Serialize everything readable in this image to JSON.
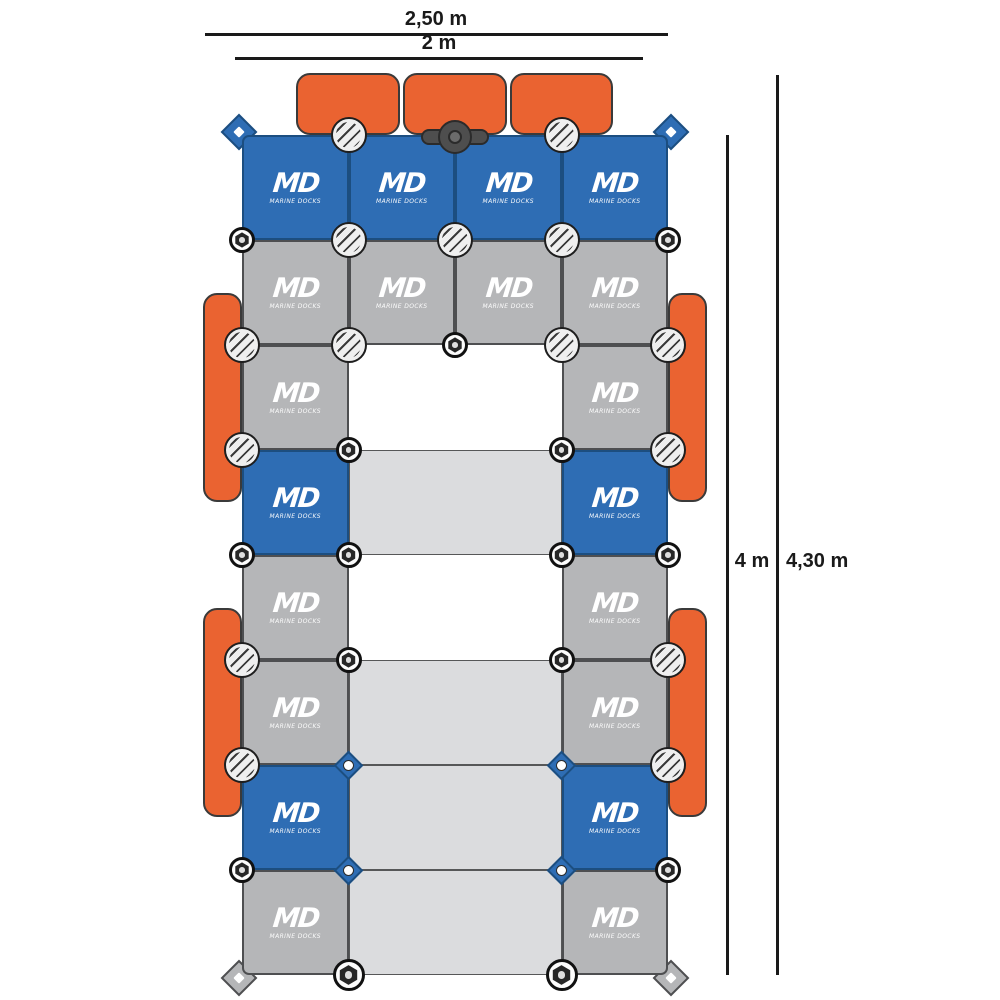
{
  "diagram_title": "Marine Docks modular pontoon layout plan",
  "dimensions": {
    "top_outer_label": "2,50 m",
    "top_inner_label": "2 m",
    "right_inner_label": "4 m",
    "right_outer_label": "4,30 m"
  },
  "logo": {
    "abbr": "MD",
    "name": "MARINE DOCKS"
  },
  "colors": {
    "module_blue": "#2E6DB4",
    "module_blue_border": "#1C4E80",
    "module_gray": "#B5B6B8",
    "walkway_panel": "#DBDCDE",
    "fender_orange": "#EA6331",
    "connector_face": "#EFEFEF",
    "line_black": "#1A1A1A",
    "background": "#FFFFFF"
  },
  "grid": {
    "origin_x": 242,
    "origin_y": 135,
    "cell_w": 106.5,
    "cell_h": 105
  },
  "modules": [
    {
      "row": 0,
      "col": 0,
      "span": 1,
      "type": "blue"
    },
    {
      "row": 0,
      "col": 1,
      "span": 1,
      "type": "blue"
    },
    {
      "row": 0,
      "col": 2,
      "span": 1,
      "type": "blue"
    },
    {
      "row": 0,
      "col": 3,
      "span": 1,
      "type": "blue"
    },
    {
      "row": 1,
      "col": 0,
      "span": 1,
      "type": "gray"
    },
    {
      "row": 1,
      "col": 1,
      "span": 1,
      "type": "gray"
    },
    {
      "row": 1,
      "col": 2,
      "span": 1,
      "type": "gray"
    },
    {
      "row": 1,
      "col": 3,
      "span": 1,
      "type": "gray"
    },
    {
      "row": 2,
      "col": 0,
      "span": 1,
      "type": "gray"
    },
    {
      "row": 2,
      "col": 3,
      "span": 1,
      "type": "gray"
    },
    {
      "row": 3,
      "col": 0,
      "span": 1,
      "type": "blue"
    },
    {
      "row": 3,
      "col": 1,
      "span": 2,
      "type": "panel"
    },
    {
      "row": 3,
      "col": 3,
      "span": 1,
      "type": "blue"
    },
    {
      "row": 4,
      "col": 0,
      "span": 1,
      "type": "gray"
    },
    {
      "row": 4,
      "col": 3,
      "span": 1,
      "type": "gray"
    },
    {
      "row": 5,
      "col": 0,
      "span": 1,
      "type": "gray"
    },
    {
      "row": 5,
      "col": 1,
      "span": 2,
      "type": "panel"
    },
    {
      "row": 5,
      "col": 3,
      "span": 1,
      "type": "gray"
    },
    {
      "row": 6,
      "col": 0,
      "span": 1,
      "type": "blue"
    },
    {
      "row": 6,
      "col": 1,
      "span": 2,
      "type": "panel"
    },
    {
      "row": 6,
      "col": 3,
      "span": 1,
      "type": "blue"
    },
    {
      "row": 7,
      "col": 0,
      "span": 1,
      "type": "gray"
    },
    {
      "row": 7,
      "col": 1,
      "span": 2,
      "type": "panel"
    },
    {
      "row": 7,
      "col": 3,
      "span": 1,
      "type": "gray"
    }
  ],
  "fenders": [
    {
      "x": 296,
      "y": 73,
      "w": 104,
      "h": 62,
      "side": "top"
    },
    {
      "x": 403,
      "y": 73,
      "w": 104,
      "h": 62,
      "side": "top"
    },
    {
      "x": 510,
      "y": 73,
      "w": 103,
      "h": 62,
      "side": "top"
    },
    {
      "x": 203,
      "y": 293,
      "w": 39,
      "h": 209,
      "side": "left"
    },
    {
      "x": 203,
      "y": 608,
      "w": 39,
      "h": 209,
      "side": "left"
    },
    {
      "x": 668,
      "y": 293,
      "w": 39,
      "h": 209,
      "side": "right"
    },
    {
      "x": 668,
      "y": 608,
      "w": 39,
      "h": 209,
      "side": "right"
    }
  ],
  "connectors": {
    "screw_caps": [
      {
        "r": 0,
        "c": 1
      },
      {
        "r": 0,
        "c": 3
      },
      {
        "r": 1,
        "c": 1
      },
      {
        "r": 1,
        "c": 2
      },
      {
        "r": 1,
        "c": 3
      },
      {
        "r": 2,
        "c": 0
      },
      {
        "r": 2,
        "c": 1
      },
      {
        "r": 2,
        "c": 3
      },
      {
        "r": 2,
        "c": 4
      },
      {
        "r": 3,
        "c": 0
      },
      {
        "r": 3,
        "c": 4
      },
      {
        "r": 5,
        "c": 0
      },
      {
        "r": 5,
        "c": 4
      },
      {
        "r": 6,
        "c": 0
      },
      {
        "r": 6,
        "c": 4
      }
    ],
    "hex_nuts": [
      {
        "r": 1,
        "c": 0
      },
      {
        "r": 1,
        "c": 4
      },
      {
        "r": 2,
        "c": 2
      },
      {
        "r": 3,
        "c": 1
      },
      {
        "r": 3,
        "c": 3
      },
      {
        "r": 4,
        "c": 0
      },
      {
        "r": 4,
        "c": 1
      },
      {
        "r": 4,
        "c": 3
      },
      {
        "r": 4,
        "c": 4
      },
      {
        "r": 5,
        "c": 1
      },
      {
        "r": 5,
        "c": 3
      },
      {
        "r": 7,
        "c": 0
      },
      {
        "r": 7,
        "c": 4
      }
    ],
    "big_hex_nuts": [
      {
        "r": 8,
        "c": 1
      },
      {
        "r": 8,
        "c": 3
      }
    ],
    "pin_holes": [
      {
        "r": 6,
        "c": 1
      },
      {
        "r": 6,
        "c": 3
      },
      {
        "r": 7,
        "c": 1
      },
      {
        "r": 7,
        "c": 3
      }
    ],
    "corner_lugs": [
      {
        "r": 0,
        "c": 0,
        "color": "blue",
        "dx": -3,
        "dy": -3
      },
      {
        "r": 0,
        "c": 4,
        "color": "blue",
        "dx": 3,
        "dy": -3
      },
      {
        "r": 8,
        "c": 0,
        "color": "gray",
        "dx": -3,
        "dy": 3
      },
      {
        "r": 8,
        "c": 4,
        "color": "gray",
        "dx": 3,
        "dy": 3
      }
    ],
    "cleat": {
      "r": 0,
      "c": 2
    }
  },
  "dimension_lines": {
    "top_outer": {
      "x1": 205,
      "x2": 668,
      "y": 34
    },
    "top_inner": {
      "x1": 235,
      "x2": 643,
      "y": 58
    },
    "right_inner": {
      "x": 727,
      "y1": 135,
      "y2": 975
    },
    "right_outer": {
      "x": 777,
      "y1": 75,
      "y2": 975
    }
  },
  "dimension_label_pos": {
    "top_outer": {
      "cx": 436,
      "top": 8
    },
    "top_inner": {
      "cx": 439,
      "top": 32
    },
    "right_inner": {
      "left": 727,
      "width": 50,
      "top": 550
    },
    "right_outer": {
      "left": 786,
      "top": 550
    }
  }
}
